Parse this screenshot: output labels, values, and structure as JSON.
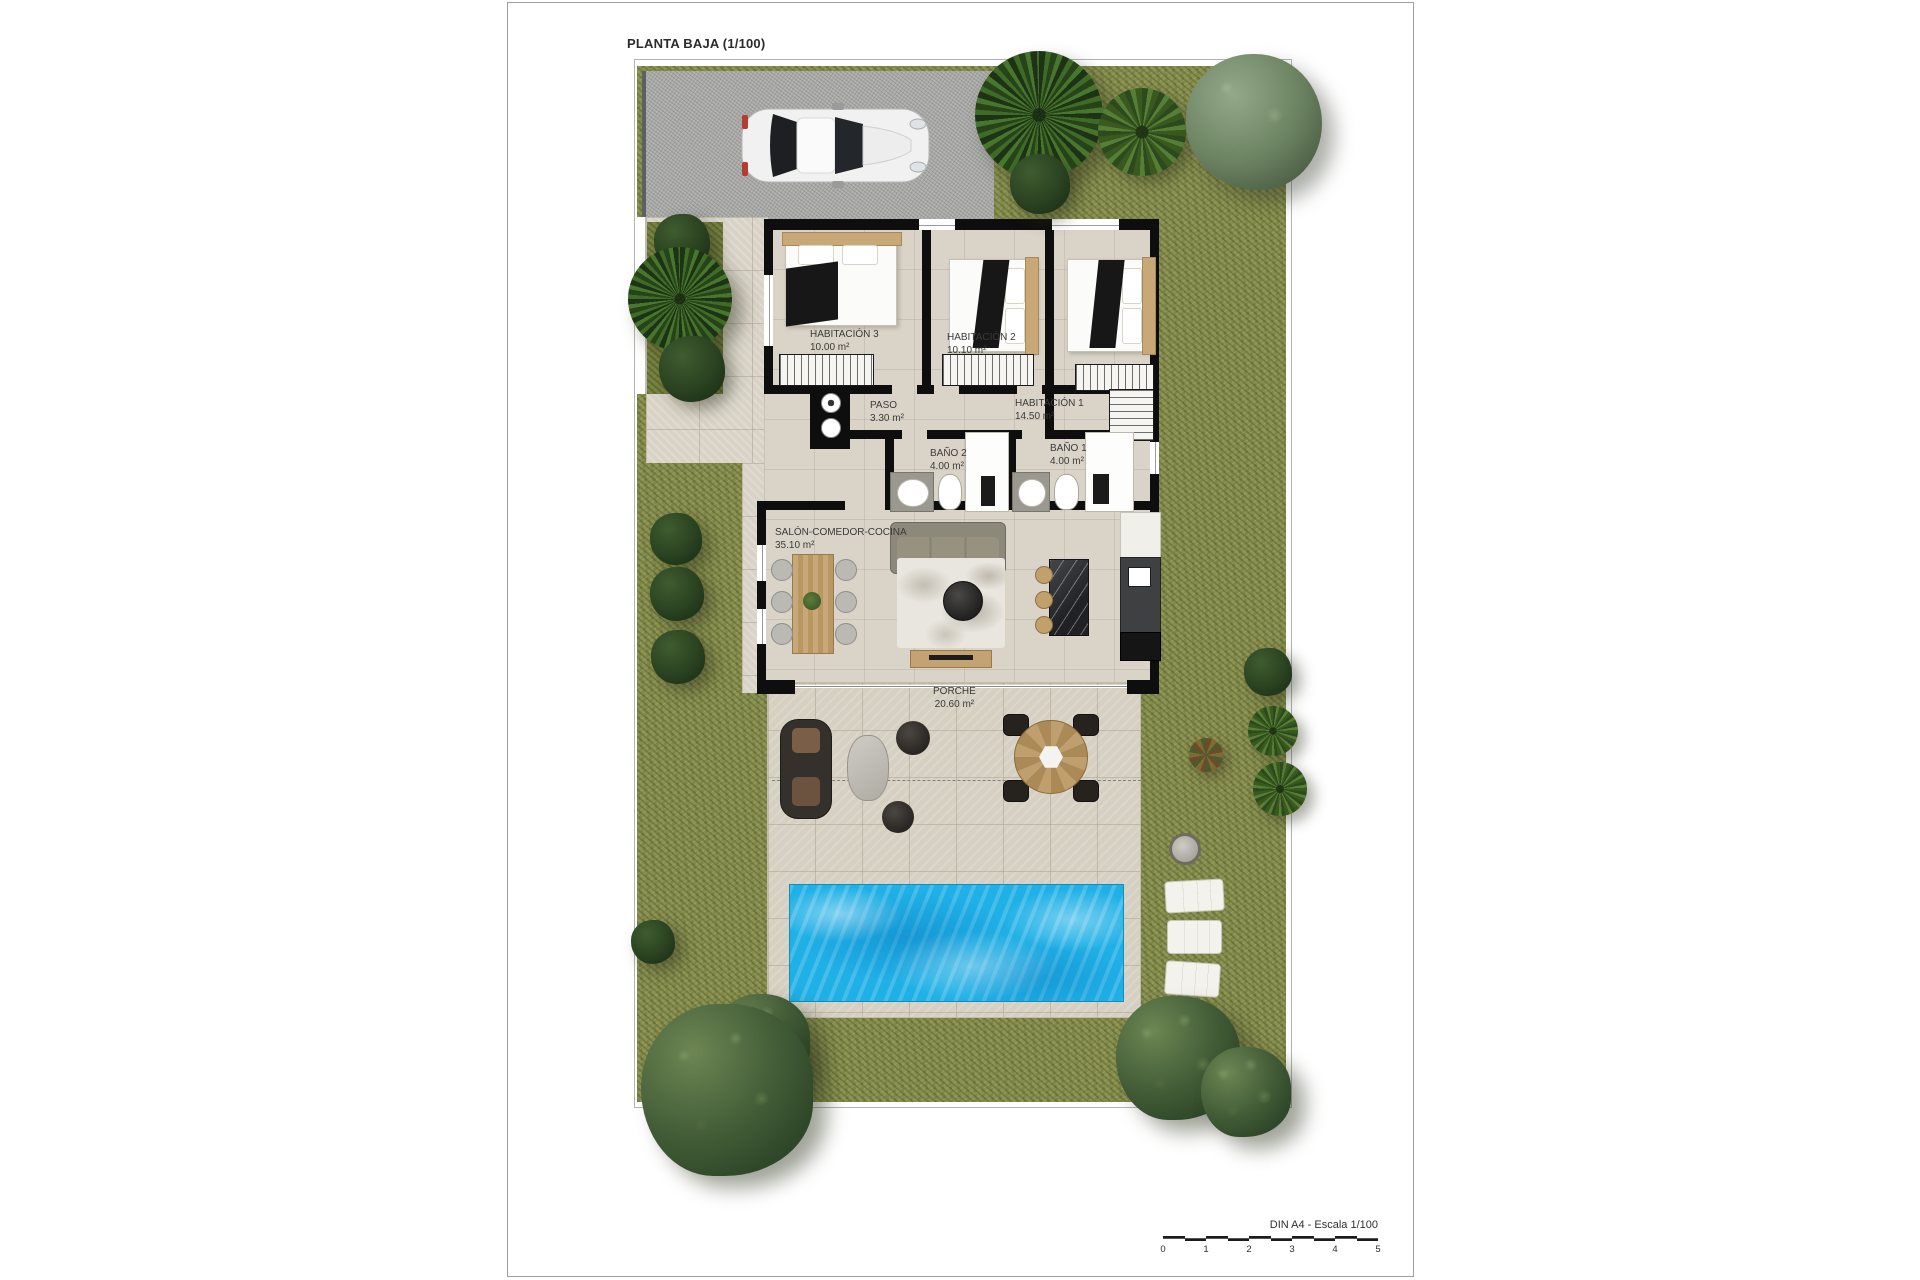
{
  "page": {
    "title": "PLANTA BAJA (1/100)"
  },
  "rooms": [
    {
      "id": "habitacion3",
      "name": "HABITACIÓN 3",
      "area": "10.00 m²"
    },
    {
      "id": "habitacion2",
      "name": "HABITACIÓN 2",
      "area": "10.10 m²"
    },
    {
      "id": "habitacion1",
      "name": "HABITACIÓN 1",
      "area": "14.50 m²"
    },
    {
      "id": "paso",
      "name": "PASO",
      "area": "3.30 m²"
    },
    {
      "id": "bano2",
      "name": "BAÑO 2",
      "area": "4.00 m²"
    },
    {
      "id": "bano1",
      "name": "BAÑO 1",
      "area": "4.00 m²"
    },
    {
      "id": "salon",
      "name": "SALÓN-COMEDOR-COCINA",
      "area": "35.10 m²"
    },
    {
      "id": "porche",
      "name": "PORCHE",
      "area": "20.60 m²"
    }
  ],
  "scale_bar": {
    "label": "DIN A4 - Escala 1/100",
    "ticks": [
      "0",
      "1",
      "2",
      "3",
      "4",
      "5"
    ]
  },
  "colors": {
    "grass": "#8a9150",
    "driveway": "#a9a9a7",
    "wall": "#0e0e0e",
    "floor_tile": "#dad4c8",
    "pool_water": "#1fb0e6",
    "wood": "#c8a878"
  }
}
